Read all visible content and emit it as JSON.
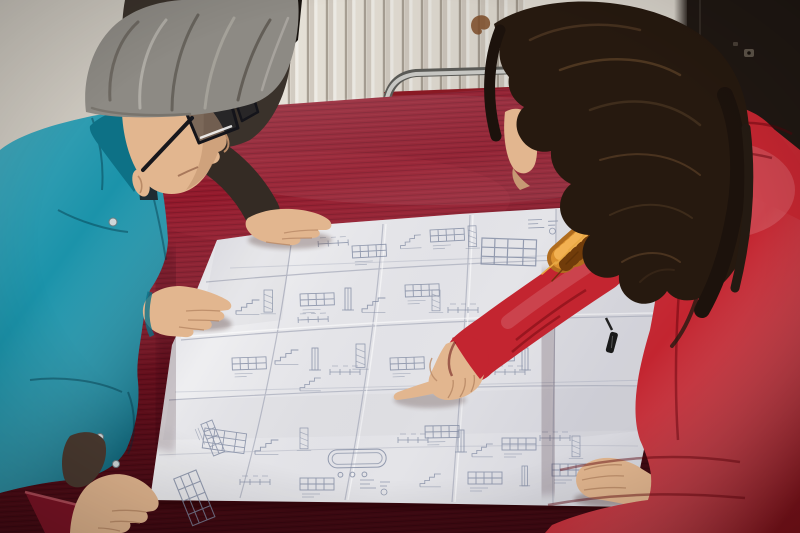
{
  "scene": {
    "type": "photograph",
    "subject": "Two workers leaning over a large folded engineering blueprint spread on a crimson velvet covered table",
    "people": {
      "left_person": "man with gray hair and dark glasses wearing a teal work jacket, hands resting on the drawing",
      "right_person": "woman in a red padded coat with an orange fur-trimmed hood, pointing at the drawing",
      "background_person": "partially visible person in a dark jacket with a hand resting on the top edge of the drawing"
    },
    "objects": {
      "blueprint": "large white multi-panel folded technical drawing sheet with many small schematic details",
      "table": "table draped in dark red velvet cloth",
      "chair": "red upholstered chair with a chrome tube frame behind the table",
      "radiator": "cream wall radiator with vertical fins",
      "door": "dark brown door on the right with a small metal keyhole plate",
      "wall_stain": "small brown stain on the wall beside the radiator"
    }
  },
  "palette": {
    "wall": "#cdc8bf",
    "wall_right": "#d8d3ca",
    "radiator": "#e8e3d9",
    "door": "#201813",
    "velvet": "#8c1527",
    "velvet_bright": "#7d1426",
    "chair_red": "#a81f2b",
    "chrome": "#c6c6c2",
    "paper": "#e9e9ec",
    "ink": "#7e88a0",
    "jacket_teal": "#1b93aa",
    "jacket_teal_dark": "#0d7186",
    "coat_red": "#c32530",
    "fur_orange": "#b06c1e",
    "hair_gray": "#8d8a84",
    "hair_dark": "#26190f",
    "dark_jacket": "#3a322b",
    "skin": "#e2b68f",
    "stain": "#7a4a26"
  }
}
